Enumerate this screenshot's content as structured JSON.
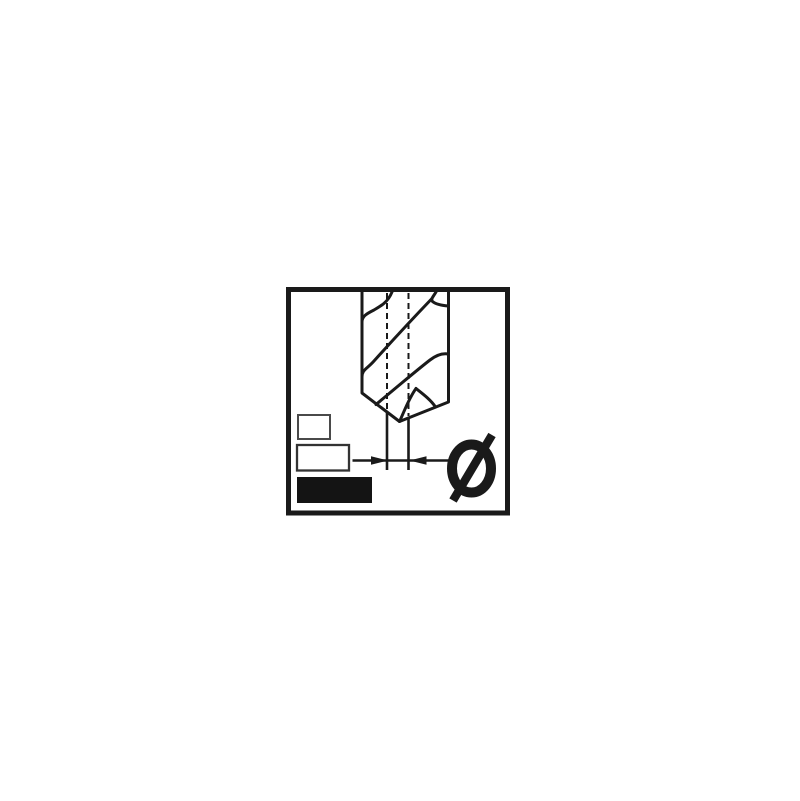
{
  "pictogram": {
    "type": "drill-bit-diameter-pictogram",
    "diameter_symbol": "Ø",
    "colors": {
      "ink": "#1a1a1a",
      "background": "#ffffff",
      "legend_small_border": "#4a4a4a",
      "legend_medium_border": "#333333",
      "legend_filled": "#141414"
    },
    "legend_rectangles": [
      {
        "order": 1,
        "style": "outline"
      },
      {
        "order": 2,
        "style": "outline"
      },
      {
        "order": 3,
        "style": "filled"
      }
    ]
  }
}
